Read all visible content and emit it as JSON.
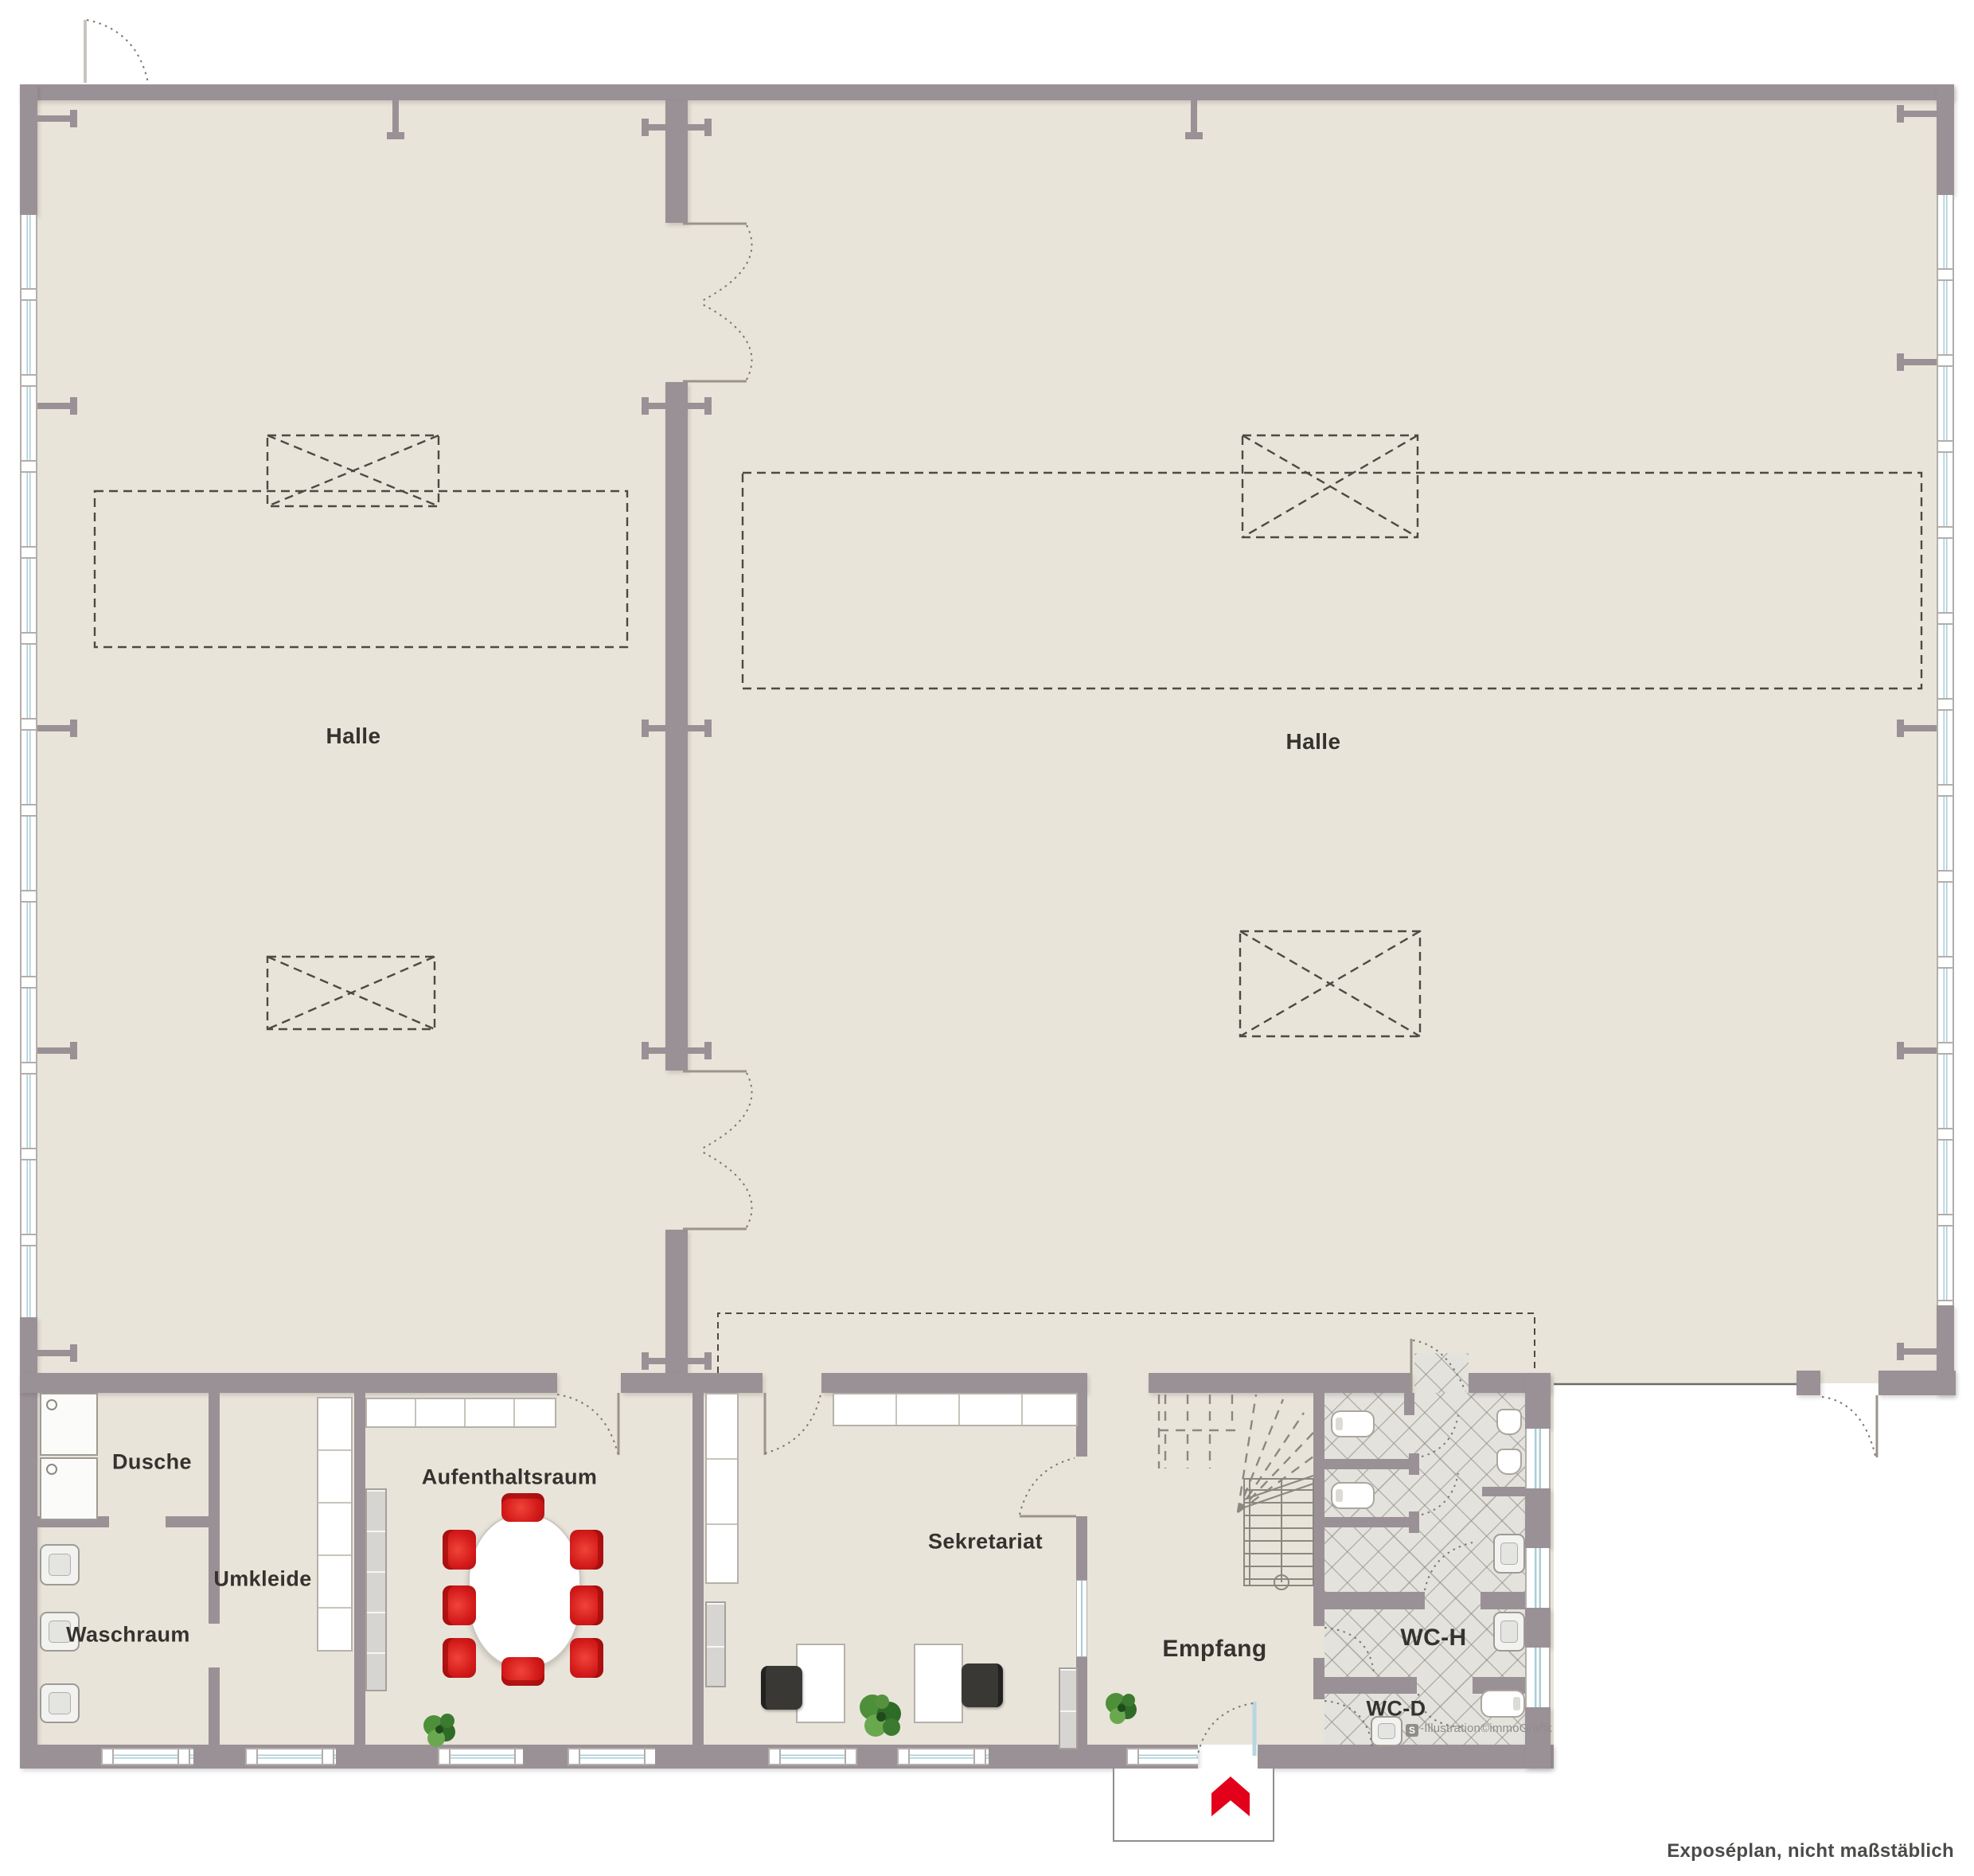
{
  "rooms": {
    "hall_left": {
      "label": "Halle"
    },
    "hall_right": {
      "label": "Halle"
    },
    "dusche": {
      "label": "Dusche"
    },
    "umkleide": {
      "label": "Umkleide"
    },
    "waschraum": {
      "label": "Waschraum"
    },
    "aufenthaltsraum": {
      "label": "Aufenthaltsraum"
    },
    "sekretariat": {
      "label": "Sekretariat"
    },
    "empfang": {
      "label": "Empfang"
    },
    "wc_h": {
      "label": "WC-H"
    },
    "wc_d": {
      "label": "WC-D"
    }
  },
  "watermark": {
    "logo": "S",
    "text": "-Illustration©immoGrafik"
  },
  "footer": {
    "note": "Exposéplan, nicht maßstäblich"
  },
  "colors": {
    "floor": "#e9e4d9",
    "wall": "#9a9196",
    "tile": "#e4e2dd",
    "window_blue": "#a9cdd9",
    "accent_red": "#e2001a",
    "chair_red": "#d31a1a",
    "dash": "#4c4a44",
    "text": "#35332f",
    "muted": "#8f8d8a"
  }
}
